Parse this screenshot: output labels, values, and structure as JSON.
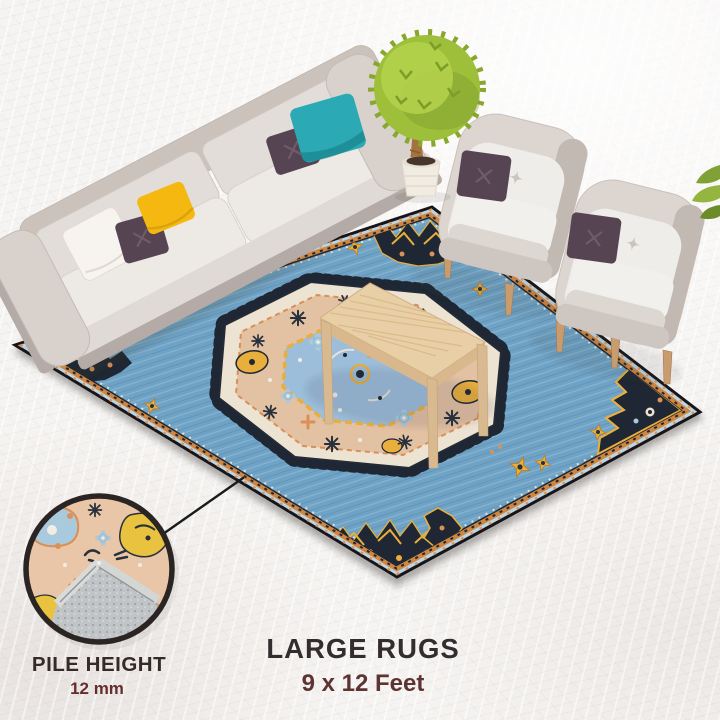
{
  "labels": {
    "product_title": "LARGE RUGS",
    "product_size": "9 x 12 Feet",
    "pile_height_label": "PILE HEIGHT",
    "pile_height_value": "12 mm"
  },
  "colors": {
    "background": "#F6F4F2",
    "title_text": "#332D2F",
    "size_text": "#5D3432",
    "pile_label_text": "#342A28",
    "pile_value_text": "#632E2D",
    "rug_edge_band": "#BBD5E3",
    "rug_border_trim": "#D0863F",
    "rug_field": "#6FA3C6",
    "rug_navy": "#1E2733",
    "rug_gold": "#E9AF3D",
    "rug_cream": "#EDE3D2",
    "rug_peach": "#E3C1A3",
    "rug_core_blue": "#9CBEDA",
    "rug_backing_gray": "#C0C4C6",
    "inset_peach": "#EAC6A8",
    "sofa_back_band": "#CBC2BC",
    "sofa_arm": "#D8D1CC",
    "sofa_shadow": "#B4ABA6",
    "cushion_light": "#EDEAE6",
    "armchair_shell": "#DCD5D0",
    "pillow_teal": "#2BA9B4",
    "pillow_purple": "#574452",
    "pillow_yellow": "#F5B811",
    "pillow_white": "#F7F4EF",
    "tree_canopy": "#9DBF3A",
    "wood_leg": "#C89C6E",
    "table_wood": "#E8CFA6"
  },
  "scene": {
    "objects": [
      "area-rug",
      "sofa",
      "armchair",
      "armchair",
      "potted-tree",
      "coffee-table",
      "pile-height-magnifier"
    ]
  }
}
